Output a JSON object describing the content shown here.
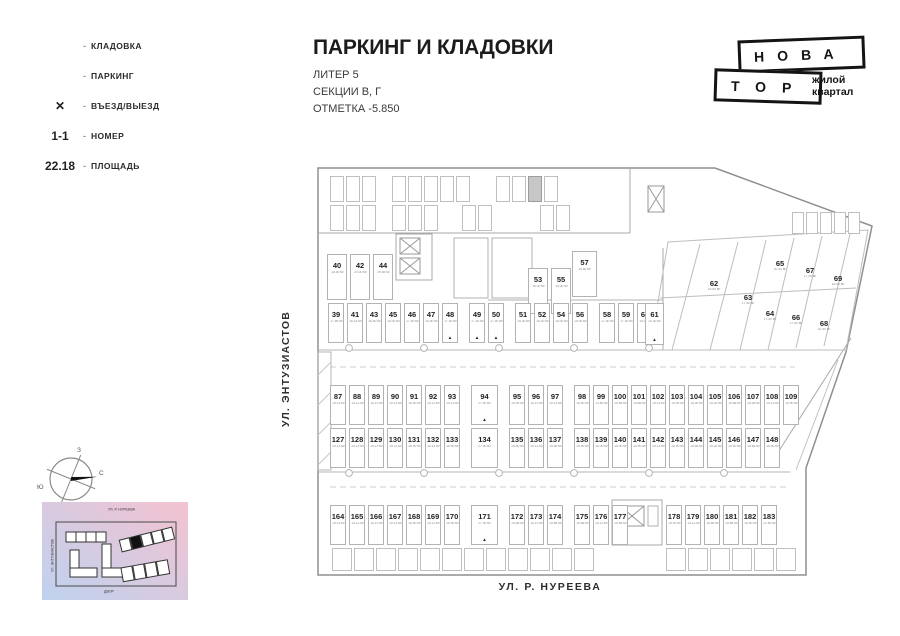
{
  "legend": {
    "items": [
      {
        "type": "sw-storage",
        "mark": "",
        "bullet": "-",
        "label": "КЛАДОВКА"
      },
      {
        "type": "sw-parking",
        "mark": "",
        "bullet": "-",
        "label": "ПАРКИНГ"
      },
      {
        "type": "x",
        "mark": "✕",
        "bullet": "-",
        "label": "ВЪЕЗД/ВЫЕЗД"
      },
      {
        "type": "num",
        "mark": "1-1",
        "bullet": "-",
        "label": "НОМЕР"
      },
      {
        "type": "area",
        "mark": "22.18",
        "bullet": "-",
        "label": "ПЛОЩАДЬ"
      }
    ]
  },
  "title": {
    "main": "ПАРКИНГ И КЛАДОВКИ",
    "line1": "ЛИТЕР 5",
    "line2": "СЕКЦИИ В, Г",
    "line3": "ОТМЕТКА -5.850"
  },
  "logo": {
    "top": "НОВА",
    "bottom": "ТОР",
    "tag1": "жилой",
    "tag2": "квартал"
  },
  "streets": {
    "left": "УЛ. ЭНТУЗИАСТОВ",
    "bottom": "УЛ. Р. НУРЕЕВА"
  },
  "compass": {
    "n": "С",
    "s": "Ю",
    "w": "З",
    "e": "В"
  },
  "minimap": {
    "street_top": "УЛ. Р. НУРЕЕВА",
    "street_left": "УЛ. ЭНТУЗИАСТОВ",
    "street_bottom": "ДВОР"
  },
  "colors": {
    "parking": "#bcdcec",
    "storage": "#e3e3e3",
    "highlight_cell": "#c7c7c7",
    "line": "#b3b3b3",
    "ink": "#141414"
  },
  "plan": {
    "rowA1": [
      {
        "n": "40",
        "a": "18.50 м²"
      },
      {
        "n": "42",
        "a": "20.00 м²"
      },
      {
        "n": "44",
        "a": "19.65 м²"
      }
    ],
    "rowA2": [
      {
        "n": "53",
        "a": "15.00 м²"
      },
      {
        "n": "55",
        "a": "15.00 м²"
      }
    ],
    "spot57": [
      {
        "n": "57",
        "a": "19.80 м²"
      }
    ],
    "rowB": [
      {
        "n": "39",
        "a": "17.85 м²"
      },
      {
        "n": "41",
        "a": "16.15 м²"
      },
      {
        "n": "43",
        "a": "16.50 м²"
      },
      {
        "n": "45",
        "a": "15.00 м²"
      },
      {
        "n": "46",
        "a": "17.40 м²"
      },
      {
        "n": "47",
        "a": "15.50 м²"
      },
      {
        "n": "48",
        "a": "17.40 м²",
        "mark": true
      },
      {
        "n": "49",
        "a": "17.40 м²",
        "gap": true,
        "mark": true
      },
      {
        "n": "50",
        "a": "17.40 м²",
        "mark": true
      },
      {
        "n": "51",
        "a": "15.30 м²",
        "gap": true
      },
      {
        "n": "52",
        "a": "15.00 м²"
      },
      {
        "n": "54",
        "a": "15.00 м²"
      },
      {
        "n": "56",
        "a": "15.00 м²"
      },
      {
        "n": "58",
        "a": "17.40 м²",
        "gap": true
      },
      {
        "n": "59",
        "a": "17.40 м²"
      },
      {
        "n": "60",
        "a": "15.00 м²"
      }
    ],
    "spot61": [
      {
        "n": "61",
        "a": "14.30 м²",
        "mark": true
      }
    ],
    "diag": [
      {
        "n": "62",
        "a": "19.84 м²",
        "x": 696,
        "y": 280,
        "mark": true
      },
      {
        "n": "63",
        "a": "17.50 м²",
        "x": 730,
        "y": 294,
        "mark": true
      },
      {
        "n": "64",
        "a": "17.50 м²",
        "x": 752,
        "y": 310
      },
      {
        "n": "65",
        "a": "20.40 м²",
        "x": 762,
        "y": 260
      },
      {
        "n": "66",
        "a": "17.50 м²",
        "x": 778,
        "y": 314
      },
      {
        "n": "67",
        "a": "17.50 м²",
        "x": 792,
        "y": 267
      },
      {
        "n": "68",
        "a": "20.50 м²",
        "x": 806,
        "y": 320
      },
      {
        "n": "69",
        "a": "18.50 м²",
        "x": 820,
        "y": 275
      }
    ],
    "rowC": [
      {
        "n": "87",
        "a": "15.13 м²"
      },
      {
        "n": "88",
        "a": "15.13 м²"
      },
      {
        "n": "89",
        "a": "15.13 м²"
      },
      {
        "n": "90",
        "a": "15.13 м²"
      },
      {
        "n": "91",
        "a": "16.90 м²"
      },
      {
        "n": "92",
        "a": "15.13 м²"
      },
      {
        "n": "93",
        "a": "15.13 м²"
      },
      {
        "n": "94",
        "a": "27.00 м²",
        "wide": true,
        "gap": true,
        "mark": true
      },
      {
        "n": "95",
        "a": "15.90 м²",
        "gap": true
      },
      {
        "n": "96",
        "a": "15.13 м²"
      },
      {
        "n": "97",
        "a": "15.13 м²"
      },
      {
        "n": "98",
        "a": "15.90 м²",
        "gap": true
      },
      {
        "n": "99",
        "a": "13.80 м²"
      },
      {
        "n": "100",
        "a": "15.85 м²"
      },
      {
        "n": "101",
        "a": "15.85 м²"
      },
      {
        "n": "102",
        "a": "15.13 м²"
      },
      {
        "n": "103",
        "a": "15.90 м²"
      },
      {
        "n": "104",
        "a": "15.90 м²"
      },
      {
        "n": "105",
        "a": "15.20 м²"
      },
      {
        "n": "106",
        "a": "15.85 м²"
      },
      {
        "n": "107",
        "a": "15.48 м²"
      },
      {
        "n": "108",
        "a": "15.13 м²"
      },
      {
        "n": "109",
        "a": "15.90 м²"
      }
    ],
    "rowD": [
      {
        "n": "127",
        "a": "15.13 м²"
      },
      {
        "n": "128",
        "a": "15.13 м²"
      },
      {
        "n": "129",
        "a": "15.13 м²"
      },
      {
        "n": "130",
        "a": "15.13 м²"
      },
      {
        "n": "131",
        "a": "16.90 м²"
      },
      {
        "n": "132",
        "a": "15.13 м²"
      },
      {
        "n": "133",
        "a": "15.90 м²"
      },
      {
        "n": "134",
        "a": "27.00 м²",
        "wide": true,
        "gap": true
      },
      {
        "n": "135",
        "a": "15.90 м²",
        "gap": true
      },
      {
        "n": "136",
        "a": "15.13 м²"
      },
      {
        "n": "137",
        "a": "15.85 м²"
      },
      {
        "n": "138",
        "a": "15.90 м²",
        "gap": true
      },
      {
        "n": "139",
        "a": "15.00 м²"
      },
      {
        "n": "140",
        "a": "15.90 м²"
      },
      {
        "n": "141",
        "a": "15.90 м²"
      },
      {
        "n": "142",
        "a": "15.13 м²"
      },
      {
        "n": "143",
        "a": "15.90 м²"
      },
      {
        "n": "144",
        "a": "15.85 м²"
      },
      {
        "n": "145",
        "a": "15.20 м²"
      },
      {
        "n": "146",
        "a": "15.90 м²"
      },
      {
        "n": "147",
        "a": "15.85 м²"
      },
      {
        "n": "148",
        "a": "15.90 м²"
      }
    ],
    "rowE1": [
      {
        "n": "164",
        "a": "15.13 м²"
      },
      {
        "n": "165",
        "a": "15.13 м²"
      },
      {
        "n": "166",
        "a": "15.13 м²"
      },
      {
        "n": "167",
        "a": "15.13 м²"
      },
      {
        "n": "168",
        "a": "15.90 м²"
      },
      {
        "n": "169",
        "a": "15.13 м²"
      },
      {
        "n": "170",
        "a": "15.90 м²"
      },
      {
        "n": "171",
        "a": "27.30 м²",
        "wide": true,
        "gap": true,
        "mark": true
      },
      {
        "n": "172",
        "a": "15.85 м²",
        "gap": true
      },
      {
        "n": "173",
        "a": "15.13 м²"
      },
      {
        "n": "174",
        "a": "15.85 м²"
      },
      {
        "n": "175",
        "a": "15.85 м²",
        "gap": true
      },
      {
        "n": "176",
        "a": "15.13 м²"
      },
      {
        "n": "177",
        "a": "15.85 м²"
      }
    ],
    "rowE2": [
      {
        "n": "178",
        "a": "19.00 м²"
      },
      {
        "n": "179",
        "a": "15.13 м²"
      },
      {
        "n": "180",
        "a": "15.85 м²"
      },
      {
        "n": "181",
        "a": "15.85 м²"
      },
      {
        "n": "182",
        "a": "15.90 м²"
      },
      {
        "n": "183",
        "a": "21.80 м²"
      }
    ],
    "storage": {
      "t1a": 3,
      "t1b": 5,
      "t1c": [
        {},
        {},
        {
          "fill": true
        },
        {}
      ],
      "t2a": 3,
      "t2b": 3,
      "t2c": 2,
      "t2d": 2,
      "tr": 5,
      "b1": 12,
      "b2": 6
    }
  }
}
